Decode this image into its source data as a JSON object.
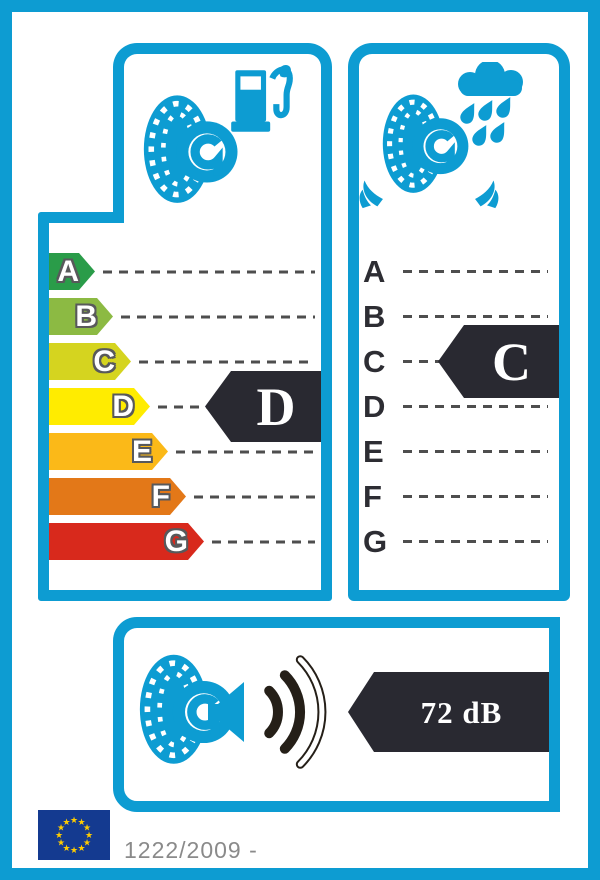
{
  "label_title": "EU tyre label",
  "colors": {
    "frame": "#0d9cd2",
    "arrow_dark": "#292931",
    "dash": "#4e4e4e",
    "scale_letter": "#2d2d33",
    "letter_outline": "#58595b",
    "wave_dark": "#251f18",
    "eu_blue": "#143a90",
    "eu_star": "#ffcc00",
    "reg_text": "#8a8a8a"
  },
  "fuel_efficiency": {
    "icon": "tire-fuel-pump-icon",
    "rating": "D",
    "scale": [
      {
        "grade": "A",
        "color": "#2a9c49",
        "bar_length": 46
      },
      {
        "grade": "B",
        "color": "#8cba43",
        "bar_length": 64
      },
      {
        "grade": "C",
        "color": "#d5d41f",
        "bar_length": 82
      },
      {
        "grade": "D",
        "color": "#ffec00",
        "bar_length": 101
      },
      {
        "grade": "E",
        "color": "#fbb918",
        "bar_length": 119
      },
      {
        "grade": "F",
        "color": "#e37818",
        "bar_length": 137
      },
      {
        "grade": "G",
        "color": "#d8291c",
        "bar_length": 155
      }
    ]
  },
  "wet_grip": {
    "icon": "tire-rain-icon",
    "rating": "C",
    "scale": [
      {
        "grade": "A"
      },
      {
        "grade": "B"
      },
      {
        "grade": "C"
      },
      {
        "grade": "D"
      },
      {
        "grade": "E"
      },
      {
        "grade": "F"
      },
      {
        "grade": "G"
      }
    ]
  },
  "noise": {
    "icon": "tire-noise-waves-icon",
    "value": "72 dB",
    "waves_filled": 2,
    "waves_total": 3
  },
  "footer": {
    "eu_flag_icon": "eu-flag-icon",
    "star_glyph": "★",
    "regulation_text": "1222/2009 -"
  }
}
